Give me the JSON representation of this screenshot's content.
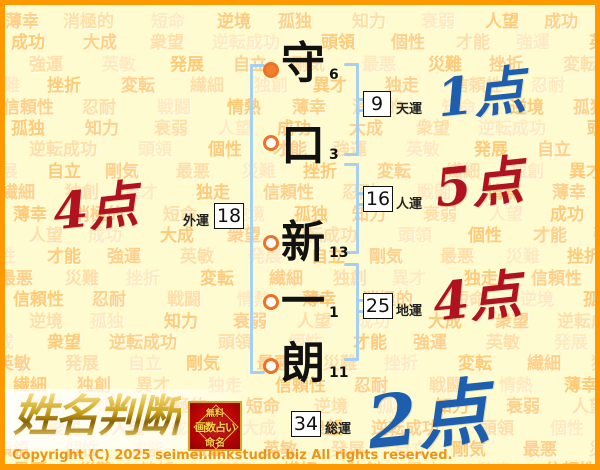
{
  "background": {
    "words": [
      "薄幸",
      "消極的",
      "短命",
      "逆境",
      "孤独",
      "知力",
      "衰弱",
      "人望",
      "成功",
      "大成",
      "衆望",
      "逆転成功",
      "頭領",
      "個性",
      "才能",
      "強運",
      "英敏",
      "発展",
      "自立",
      "剛気",
      "最悪",
      "災難",
      "挫折",
      "変転",
      "繊細",
      "独創",
      "異才",
      "独走",
      "信頼性",
      "忍耐",
      "戦闘",
      "情熱"
    ],
    "colors": [
      "#ffd089",
      "#ffdfa6",
      "#ffeabf",
      "#ffcb76"
    ]
  },
  "name_column": {
    "characters": [
      {
        "char": "守",
        "strokes": "6",
        "marker": "filled"
      },
      {
        "char": "口",
        "strokes": "3",
        "marker": "open"
      },
      {
        "char": "新",
        "strokes": "13",
        "marker": "open"
      },
      {
        "char": "一",
        "strokes": "1",
        "marker": "open"
      },
      {
        "char": "朗",
        "strokes": "11",
        "marker": "open"
      }
    ]
  },
  "fortunes": [
    {
      "id": "ten",
      "label": "天運",
      "value": "9",
      "score": "1点",
      "score_color": "blue"
    },
    {
      "id": "jin",
      "label": "人運",
      "value": "16",
      "score": "5点",
      "score_color": "red"
    },
    {
      "id": "gai",
      "label": "外運",
      "value": "18",
      "score": "4点",
      "score_color": "red"
    },
    {
      "id": "chi",
      "label": "地運",
      "value": "25",
      "score": "4点",
      "score_color": "red"
    },
    {
      "id": "sou",
      "label": "総運",
      "value": "34",
      "score": "2点",
      "score_color": "blue"
    }
  ],
  "logo": {
    "title": "姓名判断",
    "badge_lines": [
      "無料",
      "画数占い",
      "命名"
    ]
  },
  "footer": {
    "copyright": "Copyright (C) 2025 seimei.linkstudio.biz All rights reserved."
  },
  "colors": {
    "frame_orange": "#ff9902",
    "page_background": "#fffbd0",
    "score_blue": "#1d5fae",
    "score_red": "#b01220",
    "bracket_blue": "#a6d0f2",
    "marker_orange": "#f08030",
    "badge_red": "#b80404",
    "logo_gold": "#caa21c"
  }
}
